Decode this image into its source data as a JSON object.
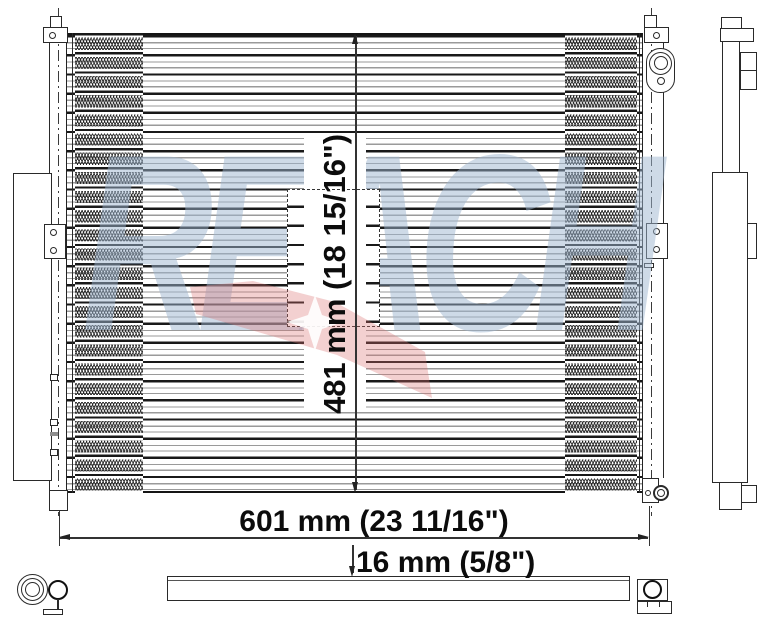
{
  "drawing": {
    "watermark_text": "REACH",
    "dimensions": {
      "width_label": "601 mm (23 11/16\")",
      "height_label": "481 mm (18 15/16\")",
      "depth_label": "16 mm (5/8\")"
    },
    "colors": {
      "line": "#2a2a2a",
      "watermark_blue": "#9db6cf",
      "watermark_red": "#db7070",
      "background": "#ffffff"
    },
    "views": {
      "front": "condenser front view",
      "side": "condenser side profile view",
      "bottom": "condenser bottom view"
    }
  }
}
